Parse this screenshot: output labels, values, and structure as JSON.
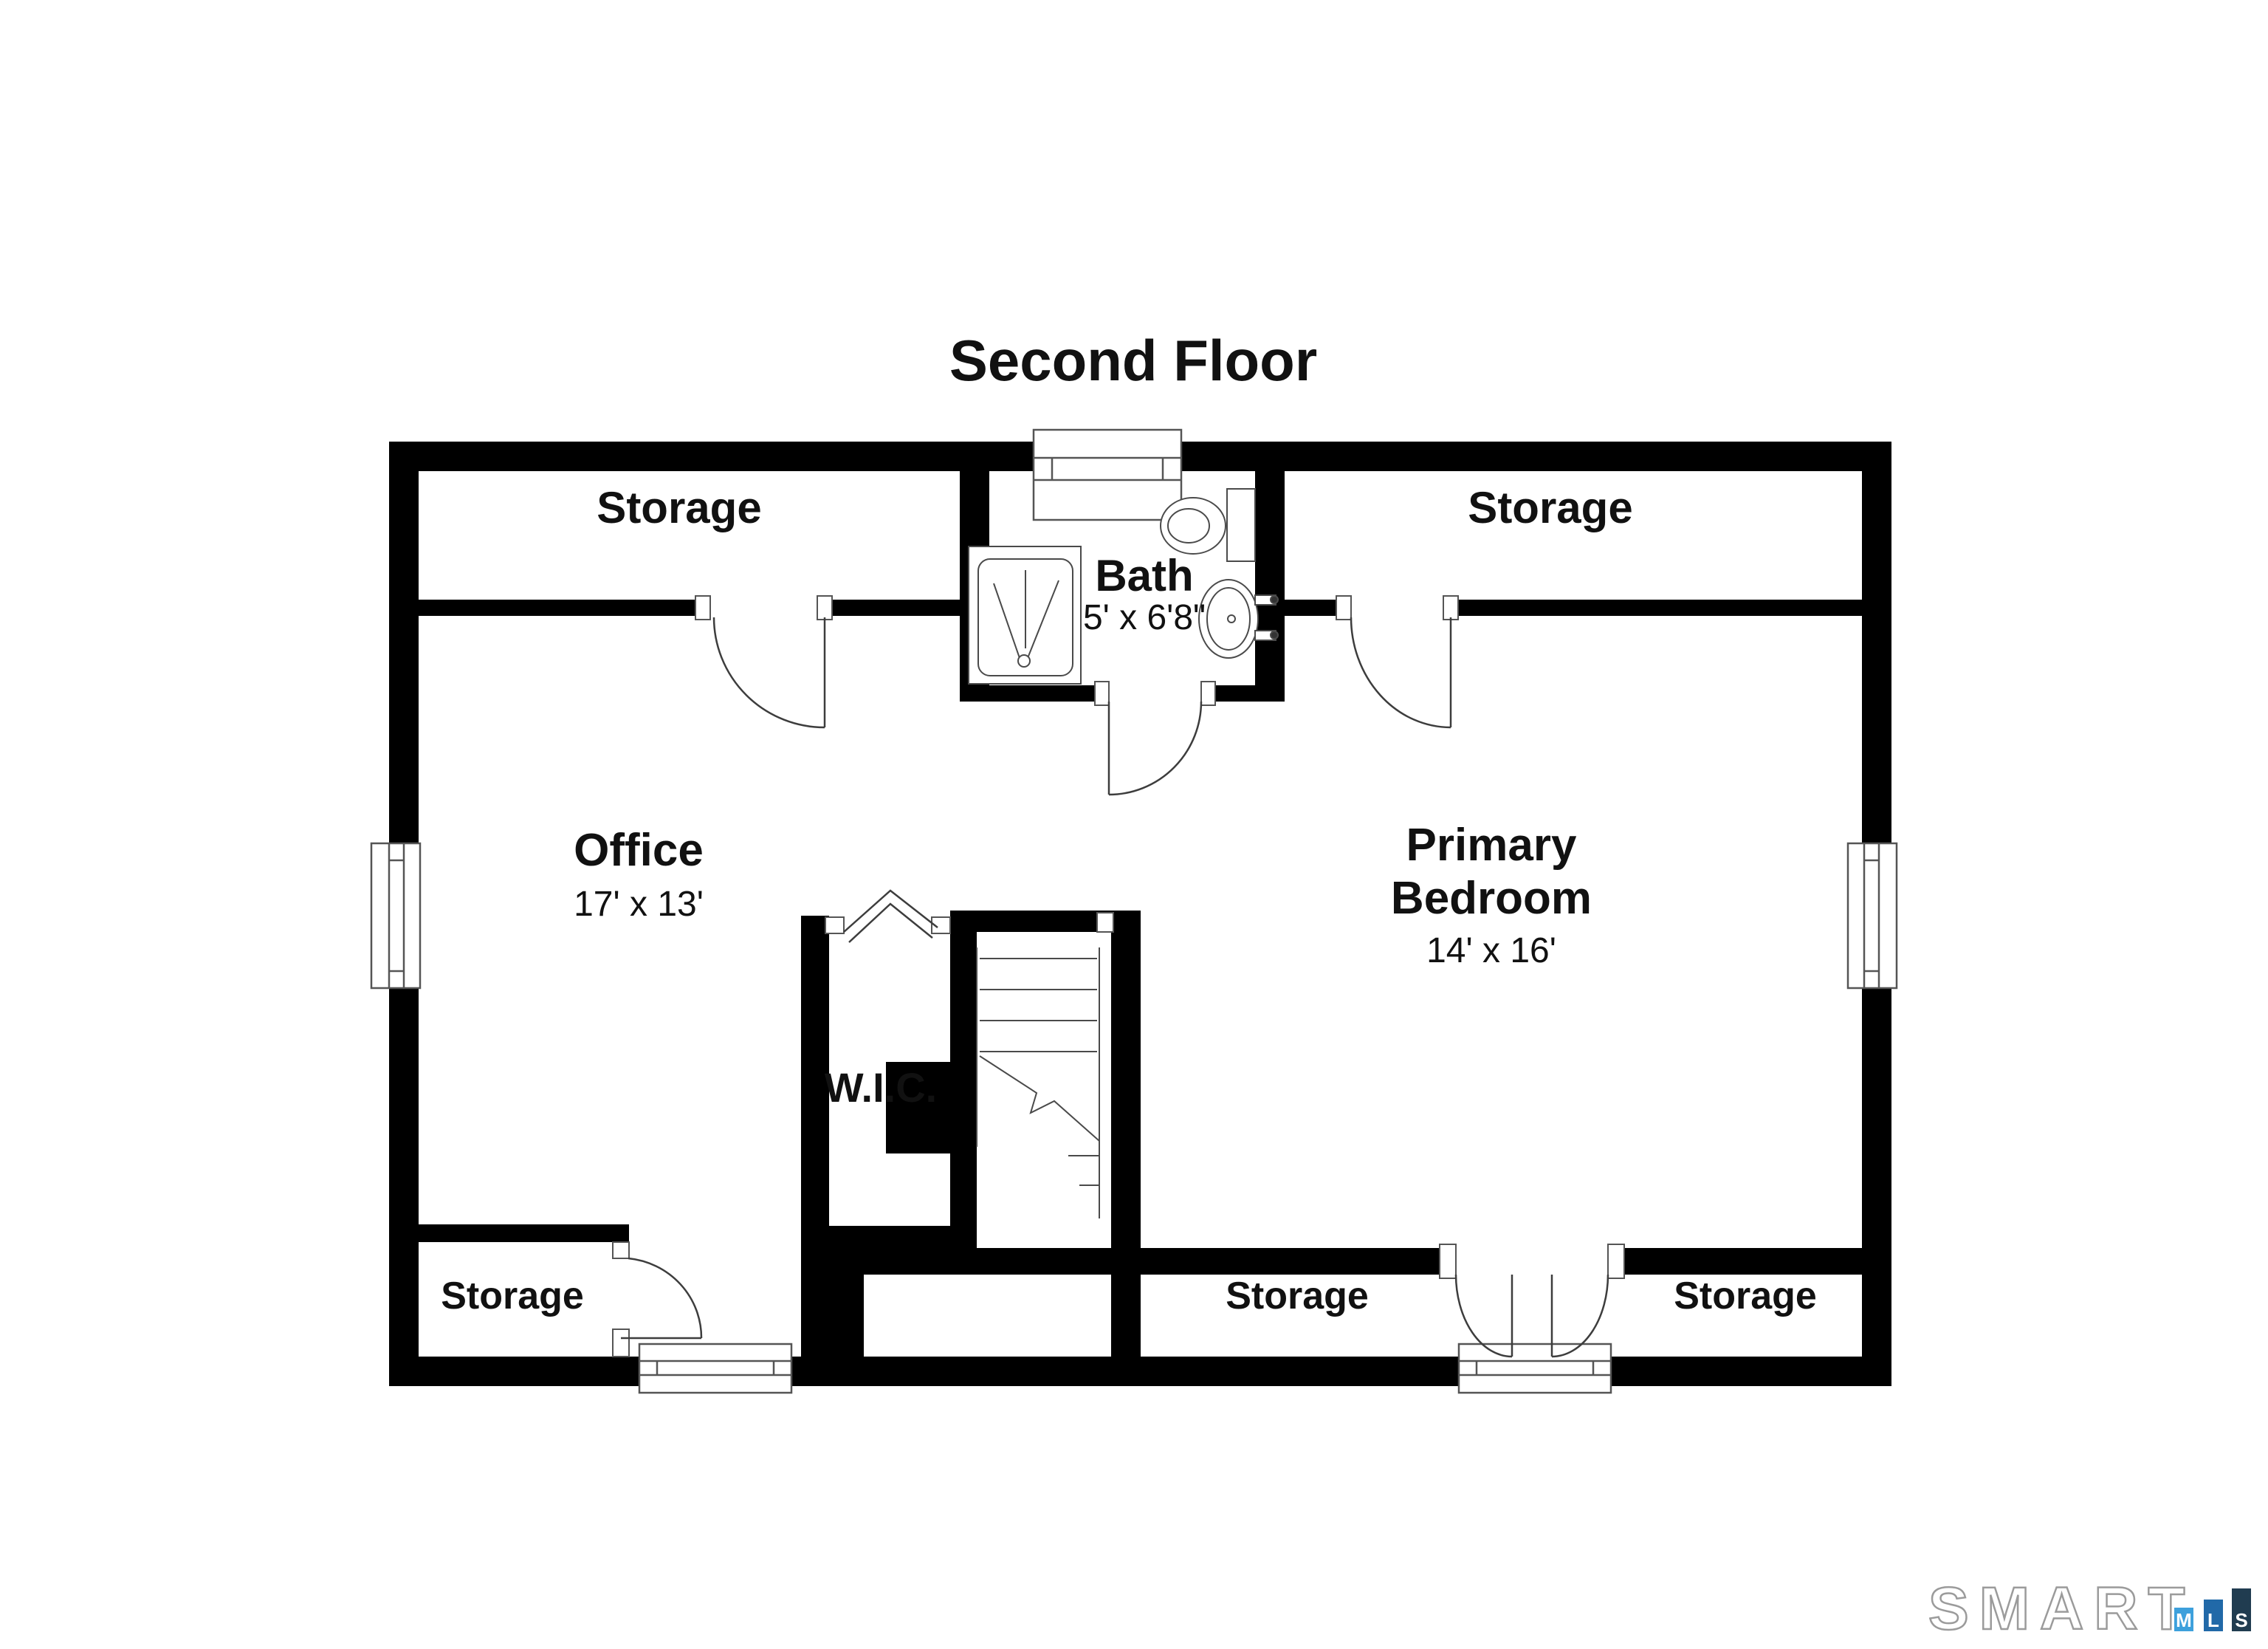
{
  "title": "Second Floor",
  "rooms": {
    "storage_top_left": {
      "label": "Storage"
    },
    "storage_top_right": {
      "label": "Storage"
    },
    "bath": {
      "label": "Bath",
      "dims": "5' x 6'8\""
    },
    "office": {
      "label": "Office",
      "dims": "17' x 13'"
    },
    "primary_bedroom": {
      "line1": "Primary",
      "line2": "Bedroom",
      "dims": "14' x 16'"
    },
    "wic": {
      "label": "W.I.C."
    },
    "storage_bottom_left": {
      "label": "Storage"
    },
    "storage_bottom_middle": {
      "label": "Storage"
    },
    "storage_bottom_right": {
      "label": "Storage"
    }
  },
  "fixtures": [
    "shower",
    "toilet",
    "sink",
    "stairs",
    "bifold-door",
    "chimney",
    "window",
    "door"
  ],
  "colors": {
    "background": "#ffffff",
    "wall": "#000000",
    "line": "#4a4a4a"
  },
  "logo": {
    "brand": "SMART",
    "outline_color": "#9b9b9b",
    "bars": [
      {
        "letter": "M",
        "color": "#3da0dc"
      },
      {
        "letter": "L",
        "color": "#2169a8"
      },
      {
        "letter": "S",
        "color": "#203c50"
      }
    ]
  }
}
